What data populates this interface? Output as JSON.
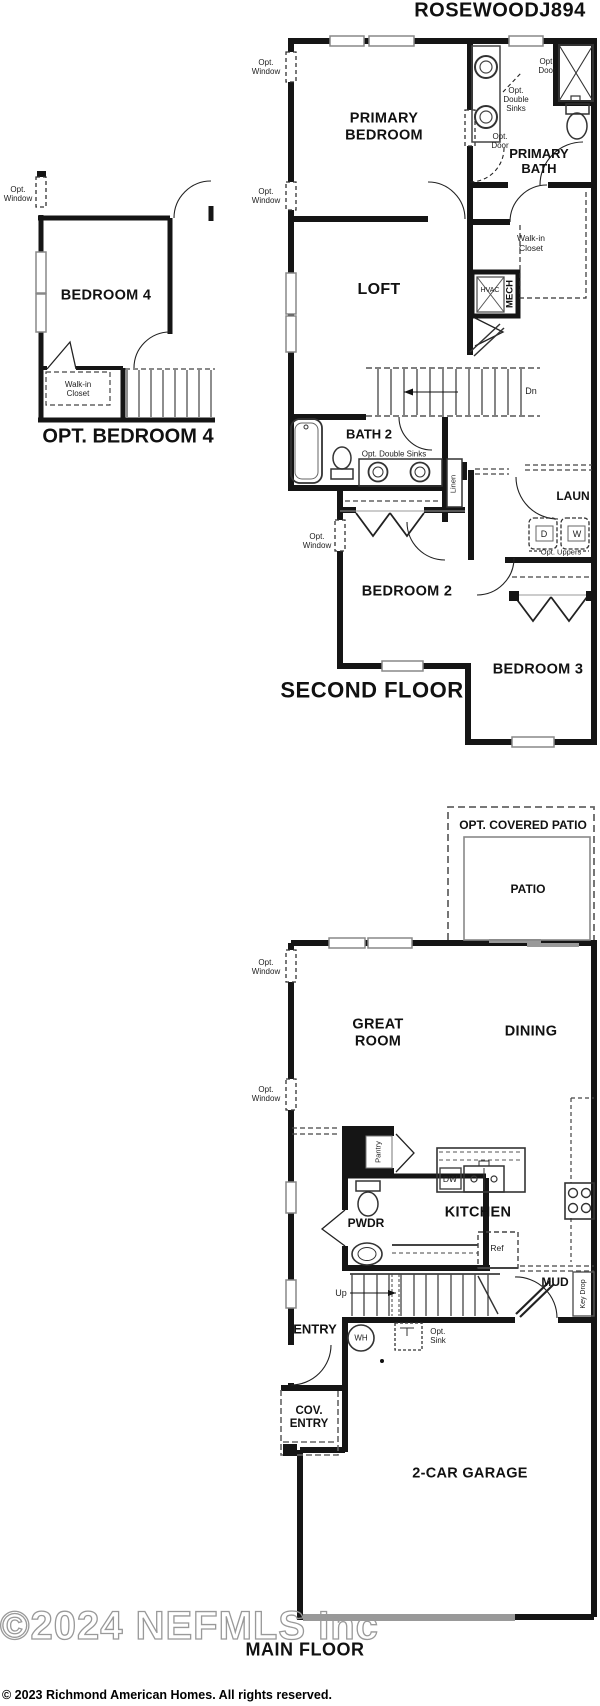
{
  "header": {
    "plan_title": "ROSEWOODJ894"
  },
  "second_floor": {
    "floor_title": "SECOND FLOOR",
    "rooms": {
      "primary_bedroom": [
        "PRIMARY",
        "BEDROOM"
      ],
      "primary_bath": [
        "PRIMARY",
        "BATH"
      ],
      "walk_in_closet": [
        "Walk-in",
        "Closet"
      ],
      "loft": "LOFT",
      "bath2": "BATH 2",
      "laundry": "LAUN",
      "bedroom2": "BEDROOM 2",
      "bedroom3": "BEDROOM 3"
    },
    "annotations": {
      "opt_window": [
        "Opt.",
        "Window"
      ],
      "opt_door": [
        "Opt.",
        "Door"
      ],
      "opt_double_sinks_stacked": [
        "Opt.",
        "Double",
        "Sinks"
      ],
      "opt_double_sinks": "Opt. Double Sinks",
      "hvac": "HVAC",
      "mech": "MECH",
      "down": "Dn",
      "linen": "Linen",
      "dryer": "D",
      "washer": "W",
      "opt_uppers": "Opt. Uppers"
    }
  },
  "opt_bedroom4": {
    "title": "OPT. BEDROOM 4",
    "rooms": {
      "bedroom4": "BEDROOM 4",
      "walk_in_closet": [
        "Walk-in",
        "Closet"
      ]
    },
    "annotations": {
      "opt_window": [
        "Opt.",
        "Window"
      ]
    }
  },
  "main_floor": {
    "floor_title": "MAIN FLOOR",
    "rooms": {
      "opt_covered_patio": "OPT. COVERED PATIO",
      "patio": "PATIO",
      "great_room": [
        "GREAT",
        "ROOM"
      ],
      "dining": "DINING",
      "kitchen": "KITCHEN",
      "pantry": "Pantry",
      "powder": "PWDR",
      "mud": "MUD",
      "entry": "ENTRY",
      "cov_entry": [
        "COV.",
        "ENTRY"
      ],
      "garage": "2-CAR GARAGE"
    },
    "annotations": {
      "opt_window": [
        "Opt.",
        "Window"
      ],
      "dw": "DW",
      "ref": "Ref",
      "up": "Up",
      "wh": "WH",
      "opt_sink": [
        "Opt.",
        "Sink"
      ],
      "key_drop": "Key Drop"
    }
  },
  "footer": {
    "watermark": "©2024 NEFMLS Inc",
    "copyright": "© 2023 Richmond American Homes. All rights reserved."
  },
  "colors": {
    "wall": "#151515",
    "fixture": "#444444",
    "watermark": "#999999"
  }
}
